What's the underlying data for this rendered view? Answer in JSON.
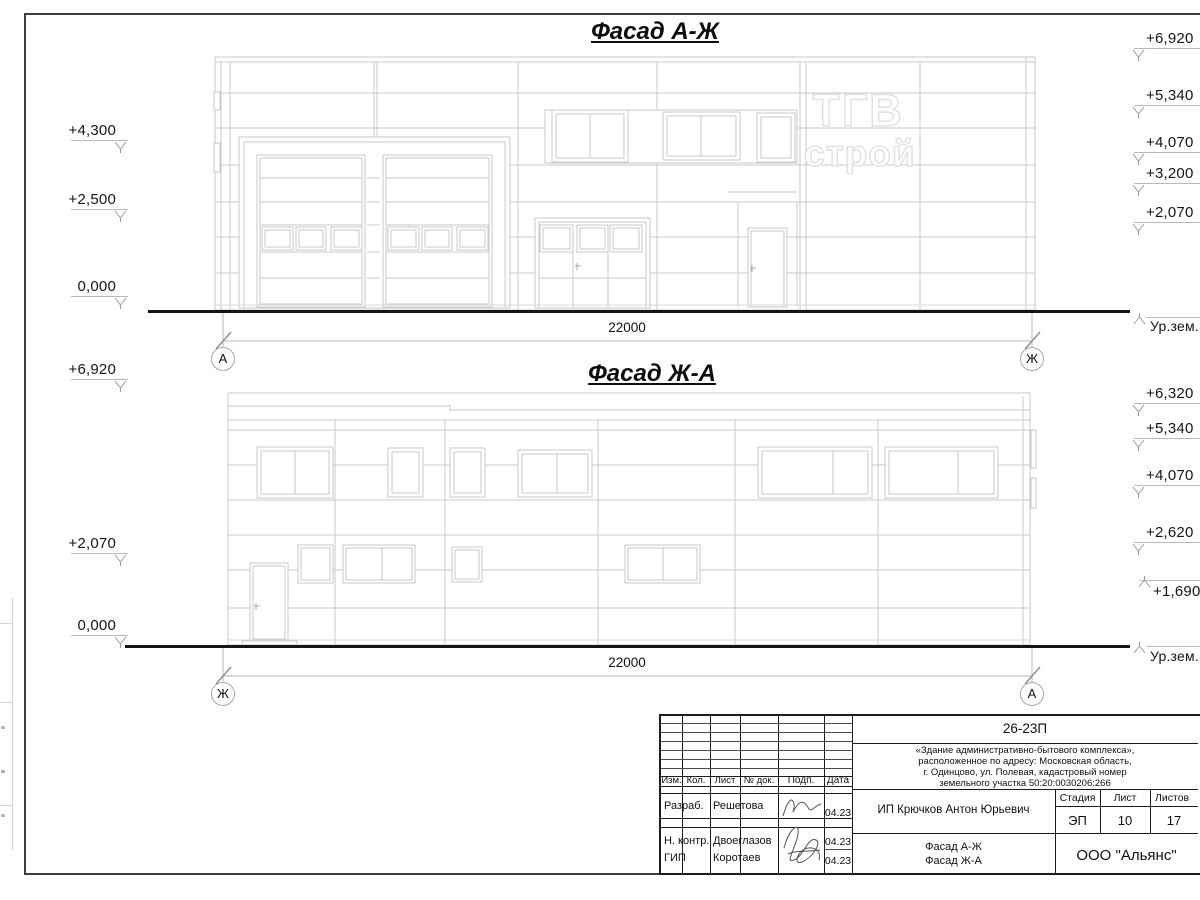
{
  "sheet": {
    "titles": {
      "top": "Фасад А-Ж",
      "bottom": "Фасад Ж-А"
    },
    "dimension_top": "22000",
    "dimension_bottom": "22000",
    "ground_label": "Ур.зем.",
    "axes": {
      "top_left": "А",
      "top_right": "Ж",
      "bottom_left": "Ж",
      "bottom_right": "А"
    },
    "watermark": {
      "line1": "ТГВ",
      "line2": "строй"
    }
  },
  "elevation_marks": {
    "top_left": [
      "+4,300",
      "+2,500",
      "0,000"
    ],
    "top_right": [
      "+6,920",
      "+5,340",
      "+4,070",
      "+3,200",
      "+2,070"
    ],
    "bottom_left": [
      "+6,920",
      "+2,070",
      "0,000"
    ],
    "bottom_right": [
      "+6,320",
      "+5,340",
      "+4,070",
      "+2,620",
      "+1,690"
    ]
  },
  "title_block": {
    "doc_number": "26-23П",
    "description_lines": [
      "«Здание административно-бытового комплекса»,",
      "расположенное по адресу: Московская область,",
      "г. Одинцово, ул. Полевая, кадастровый номер",
      "земельного участка 50:20:0030206:266"
    ],
    "header_cols": [
      "Изм.",
      "Кол.",
      "Лист",
      "№ док.",
      "Подп.",
      "Дата"
    ],
    "rows": [
      {
        "role": "Разраб.",
        "name": "Решетова",
        "date": "04.23"
      },
      {
        "role": "Н. контр.",
        "name": "Двоеглазов",
        "date": "04.23"
      },
      {
        "role": "ГИП",
        "name": "Коротаев",
        "date": "04.23"
      }
    ],
    "client": "ИП Крючков Антон Юрьевич",
    "stage_header": [
      "Стадия",
      "Лист",
      "Листов"
    ],
    "stage_values": [
      "ЭП",
      "10",
      "17"
    ],
    "sheet_title_lines": [
      "Фасад А-Ж",
      "Фасад Ж-А"
    ],
    "company": "ООО \"Альянс\""
  }
}
